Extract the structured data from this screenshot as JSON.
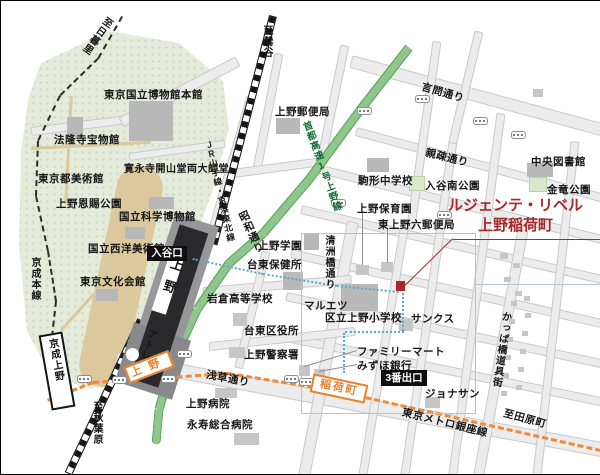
{
  "property": {
    "name_line1": "ルジェンテ・リベル",
    "name_line2": "上野稲荷町"
  },
  "stations": {
    "jr_ueno": "上野",
    "iriya_exit": "入谷口",
    "atre": "アトレ",
    "keisei_ueno": "京成上野",
    "ginza_ueno": "上野",
    "inaricho": "稲荷町",
    "exit3": "3番出口"
  },
  "railways": {
    "jr": "ＪＲ山手線・京浜東北線",
    "keisei": "京成本線",
    "ginza": "東京メトロ銀座線"
  },
  "roads": {
    "kototoi": "言問通り",
    "shinso": "親疎通り",
    "showa": "昭和通り",
    "shuto_expwy": "首都高速1号上野線",
    "kiyosubashi": "清洲橋通り",
    "asakusa": "浅草通り",
    "kappabashi": "かっぱ橋道具街"
  },
  "directions": {
    "nippori": "至日暮里",
    "uguisudani": "至鶯谷",
    "akihabara": "至秋葉原",
    "tawaramachi": "至田原町"
  },
  "places": {
    "museum_honkan": "東京国立博物館本館",
    "horyuji": "法隆寺宝物館",
    "kaneiji": "寛永寺開山堂両大師堂",
    "tobikan": "東京都美術館",
    "ueno_park": "上野恩賜公園",
    "kahaku": "国立科学博物館",
    "seiyo": "国立西洋美術館",
    "bunka_kaikan": "東京文化会館",
    "ueno_post": "上野郵便局",
    "komagata_jhs": "駒形中学校",
    "chuo_library": "中央図書館",
    "iriya_minami_park": "入谷南公園",
    "kinryu_park": "金竜公園",
    "ueno_hoikuen": "上野保育園",
    "higashi_ueno_post": "東上野六郵便局",
    "ueno_gakuen": "上野学園",
    "taito_hokenjo": "台東保健所",
    "iwakura_hs": "岩倉高等学校",
    "maruetsu": "マルエツ",
    "ueno_elementary": "区立上野小学校",
    "sunkus": "サンクス",
    "taito_kuyakusho": "台東区役所",
    "ueno_police": "上野警察署",
    "familymart": "ファミリーマート",
    "mizuho": "みずほ銀行",
    "jonathan": "ジョナサン",
    "ueno_hospital": "上野病院",
    "eiju_hospital": "永寿総合病院"
  },
  "colors": {
    "property_red": "#a8282a",
    "expressway_green": "#8fc78b",
    "ginza_orange": "#ef8a3c",
    "park_green": "#e4ebdb",
    "route_blue": "#58a7d6",
    "rail_black": "#141414"
  }
}
